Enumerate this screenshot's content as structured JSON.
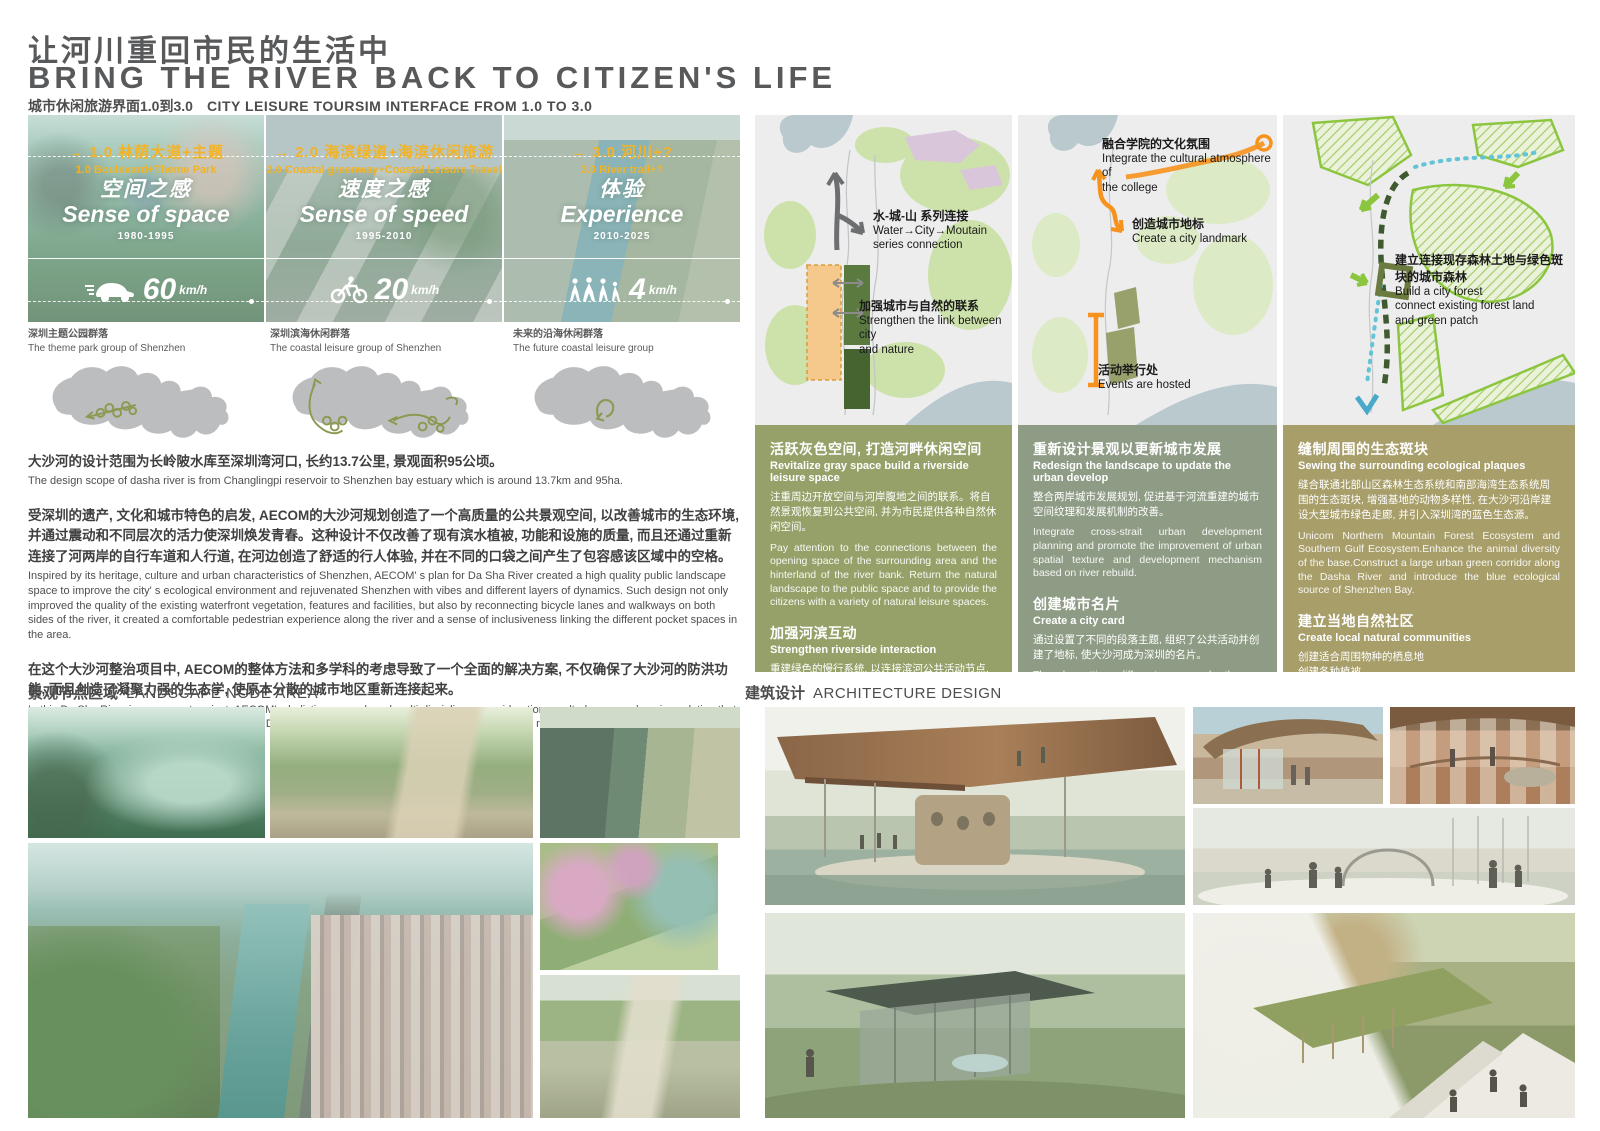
{
  "header": {
    "title_zh": "让河川重回市民的生活中",
    "title_en": "BRING THE RIVER BACK TO CITIZEN'S LIFE",
    "subtitle_zh": "城市休闲旅游界面1.0到3.0",
    "subtitle_en": "CITY LEISURE TOURSIM INTERFACE FROM 1.0 TO 3.0"
  },
  "icons": {
    "arrow_right": "→"
  },
  "eras": [
    {
      "tag_zh": "1.0 林荫大道+主题",
      "tag_en": "1.0 Boulevard+Theme Park",
      "name_zh": "空间之感",
      "name_en": "Sense of space",
      "period": "1980-1995",
      "speed": "60",
      "speed_unit": "km/h",
      "icon": "car-icon"
    },
    {
      "tag_zh": "2.0 海滨绿道+海滨休闲旅游",
      "tag_en": "2.0 Coastal greenway+Coastal Leisure Travel",
      "name_zh": "速度之感",
      "name_en": "Sense of speed",
      "period": "1995-2010",
      "speed": "20",
      "speed_unit": "km/h",
      "icon": "bicycle-icon"
    },
    {
      "tag_zh": "3.0 河川+?",
      "tag_en": "3.0 River trail+?",
      "name_zh": "体验",
      "name_en": "Experience",
      "period": "2010-2025",
      "speed": "4",
      "speed_unit": "km/h",
      "icon": "pedestrians-icon"
    }
  ],
  "shenzhen_maps": [
    {
      "caption_zh": "深圳主题公园群落",
      "caption_en": "The theme park group of Shenzhen"
    },
    {
      "caption_zh": "深圳滨海休闲群落",
      "caption_en": "The coastal leisure group of Shenzhen"
    },
    {
      "caption_zh": "未来的沿海休闲群落",
      "caption_en": "The future coastal leisure group"
    }
  ],
  "intro": {
    "p1_zh": "大沙河的设计范围为长岭陂水库至深圳湾河口, 长约13.7公里, 景观面积95公顷。",
    "p1_en": "The design scope of dasha river is from Changlingpi reservoir to Shenzhen bay estuary which is around 13.7km and 95ha.",
    "p2_zh": "受深圳的遗产, 文化和城市特色的启发, AECOM的大沙河规划创造了一个高质量的公共景观空间, 以改善城市的生态环境, 并通过震动和不同层次的活力使深圳焕发青春。这种设计不仅改善了现有滨水植被, 功能和设施的质量, 而且还通过重新连接了河两岸的自行车道和人行道, 在河边创造了舒适的行人体验, 并在不同的口袋之间产生了包容感该区域中的空格。",
    "p2_en": "Inspired by its heritage, culture and urban characteristics of Shenzhen, AECOM' s plan for Da Sha River created a high quality public landscape space to improve the city' s ecological environment and rejuvenated Shenzhen with vibes and different layers of dynamics. Such design not only improved the quality of the existing waterfront vegetation, features and facilities, but also by reconnecting bicycle lanes and walkways on both sides of the river, it created a comfortable pedestrian experience along the river and a sense of inclusiveness linking the different pocket spaces in the area.",
    "p3_zh": "在这个大沙河整治项目中, AECOM的整体方法和多学科的考虑导致了一个全面的解决方案, 不仅确保了大沙河的防洪功能, 而且创造了凝聚力强的生态学, 使原本分散的城市地区重新连接起来。",
    "p3_en": "In this Da Sha River improvement project, AECOM' s holistic approach and multi-disciplinary consideration resulted a comprehensive solution that not only ensured the flood control function of the Da Sha River, but also created a cohesive ecology that reconnected the originally fragmented urban areas."
  },
  "diagrams": [
    {
      "annotations": [
        {
          "zh": "水-城-山 系列连接",
          "en": "Water→City→Moutain\nseries connection"
        },
        {
          "zh": "加强城市与自然的联系",
          "en": "Strengthen the link between city\nand nature"
        }
      ]
    },
    {
      "annotations": [
        {
          "zh": "融合学院的文化氛围",
          "en": "Integrate the cultural atmosphere of\nthe college"
        },
        {
          "zh": "创造城市地标",
          "en": "Create a city landmark"
        },
        {
          "zh": "活动举行处",
          "en": "Events are hosted"
        }
      ]
    },
    {
      "annotations": [
        {
          "zh": "建立连接现存森林土地与绿色斑块的城市森林",
          "en": "Build a city forest\nconnect existing forest land\nand green patch"
        }
      ]
    }
  ],
  "strategy_blocks": [
    {
      "sections": [
        {
          "t_zh": "活跃灰色空间, 打造河畔休闲空间",
          "t_en": "Revitalize gray space build a riverside leisure space",
          "b_zh": "注重周边开放空间与河岸腹地之间的联系。将自然景观恢复到公共空间, 并为市民提供各种自然休闲空间。",
          "b_en": "Pay attention to the connections between the opening space of the surrounding area and the hinterland of the river bank. Return the natural landscape to the public space and to provide the citizens with a variety of natural leisure spaces."
        },
        {
          "t_zh": "加强河滨互动",
          "t_en": "Strengthen riverside interaction",
          "b_zh": "重建绿色的慢行系统, 以连接滨河公共活动节点, 加强与周围空间的连接, 并改善大沙河的生态走廊。",
          "b_en": "Rebuild a green slow-moving system to connect the riverside public activity nodes , enhances the connection of the surrounding space and improves the Dasha River ecological corridor."
        }
      ]
    },
    {
      "sections": [
        {
          "t_zh": "重新设计景观以更新城市发展",
          "t_en": "Redesign the landscape to update the urban develop",
          "b_zh": "整合两岸城市发展规划, 促进基于河流重建的城市空间纹理和发展机制的改善。",
          "b_en": "Integrate cross-strait urban development planning and promote the improvement of urban spatial texture and development mechanism based on river rebuild."
        },
        {
          "t_zh": "创建城市名片",
          "t_en": "Create a city card",
          "b_zh": "通过设置了不同的段落主题, 组织了公共活动并创建了地标, 使大沙河成为深圳的名片。",
          "b_en": "Though setting different paragraph themes, organizing public events and creating landmarks  to make Dasha river become Shenzhen 's name card."
        }
      ]
    },
    {
      "sections": [
        {
          "t_zh": "缝制周围的生态斑块",
          "t_en": "Sewing the surrounding ecological plaques",
          "b_zh": "缝合联通北部山区森林生态系统和南部海湾生态系统周围的生态斑块, 增强基地的动物多样性, 在大沙河沿岸建设大型城市绿色走廊, 并引入深圳湾的蓝色生态源。",
          "b_en": "Unicom Northern Mountain Forest Ecosystem and Southern Gulf Ecosystem.Enhance the animal diversity of the base.Construct a large urban green corridor along the Dasha River and introduce the blue ecological source of Shenzhen Bay."
        },
        {
          "t_zh": "建立当地自然社区",
          "t_en": "Create local natural communities",
          "b_zh": "创建适合周围物种的栖息地\n创建各种植被。\n增强现场动植物的多样性。",
          "b_en": "Create habitats suitable for surrounding species\nCreate diverse vegetation groups.\nEnhance the diversity of animals and plants on the site."
        }
      ]
    }
  ],
  "sections": {
    "landscape_zh": "景观节点区域",
    "landscape_en": "LANDSCAPE NODE AREA",
    "architecture_zh": "建筑设计",
    "architecture_en": "ARCHITECTURE DESIGN"
  },
  "colors": {
    "title_gray": "#58595b",
    "accent_yellow": "#f2b326",
    "accent_orange": "#f6921e",
    "block_olive": "#95a169",
    "block_sage": "#8f9c85",
    "block_khaki": "#a79e6a",
    "map_silhouette": "#bcbdbf",
    "map_scribble": "#8a9a52",
    "route_green": "#3f5a2e",
    "eco_blue": "#62c4d6"
  }
}
